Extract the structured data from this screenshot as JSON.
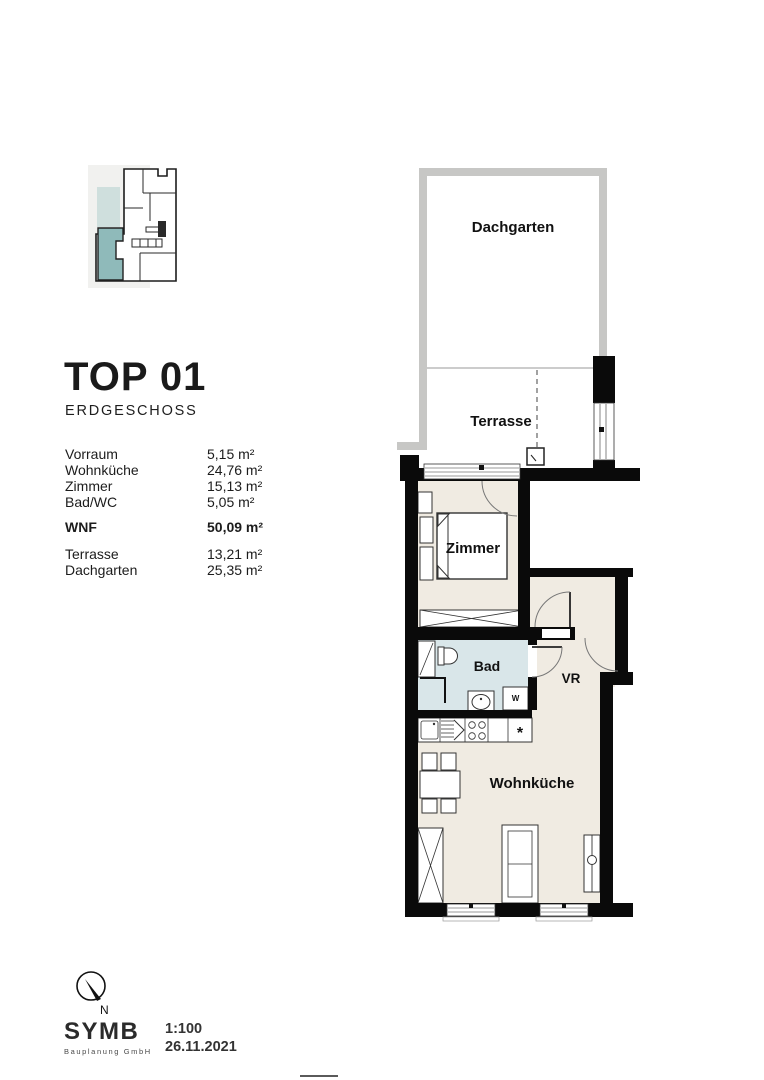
{
  "title": {
    "name": "TOP 01",
    "floor": "ERDGESCHOSS"
  },
  "areas": [
    {
      "label": "Vorraum",
      "value": "5,15 m²"
    },
    {
      "label": "Wohnküche",
      "value": "24,76 m²"
    },
    {
      "label": "Zimmer",
      "value": "15,13 m²"
    },
    {
      "label": "Bad/WC",
      "value": "5,05 m²"
    }
  ],
  "total": {
    "label": "WNF",
    "value": "50,09 m²"
  },
  "outdoor_areas": [
    {
      "label": "Terrasse",
      "value": "13,21 m²"
    },
    {
      "label": "Dachgarten",
      "value": "25,35 m²"
    }
  ],
  "plan": {
    "labels": {
      "dachgarten": "Dachgarten",
      "terrasse": "Terrasse",
      "zimmer": "Zimmer",
      "bad": "Bad",
      "vr": "VR",
      "wohnkueche": "Wohnküche"
    },
    "appliances": {
      "washer": "W",
      "fridge": "*"
    }
  },
  "footer": {
    "north_label": "N",
    "logo": "SYMB",
    "logo_subtitle": "Bauplanung GmbH",
    "scale": "1:100",
    "date": "26.11.2021"
  },
  "colors": {
    "floor": "#f0ebe2",
    "bad-floor": "#d9e6e9",
    "wall": "#0a0a0a",
    "terrace-wall": "#c7c7c5",
    "keyplan-bg": "#f1f1ef",
    "keyplan-terrace": "#cfdfdd",
    "keyplan-highlight": "#8fbaba"
  }
}
